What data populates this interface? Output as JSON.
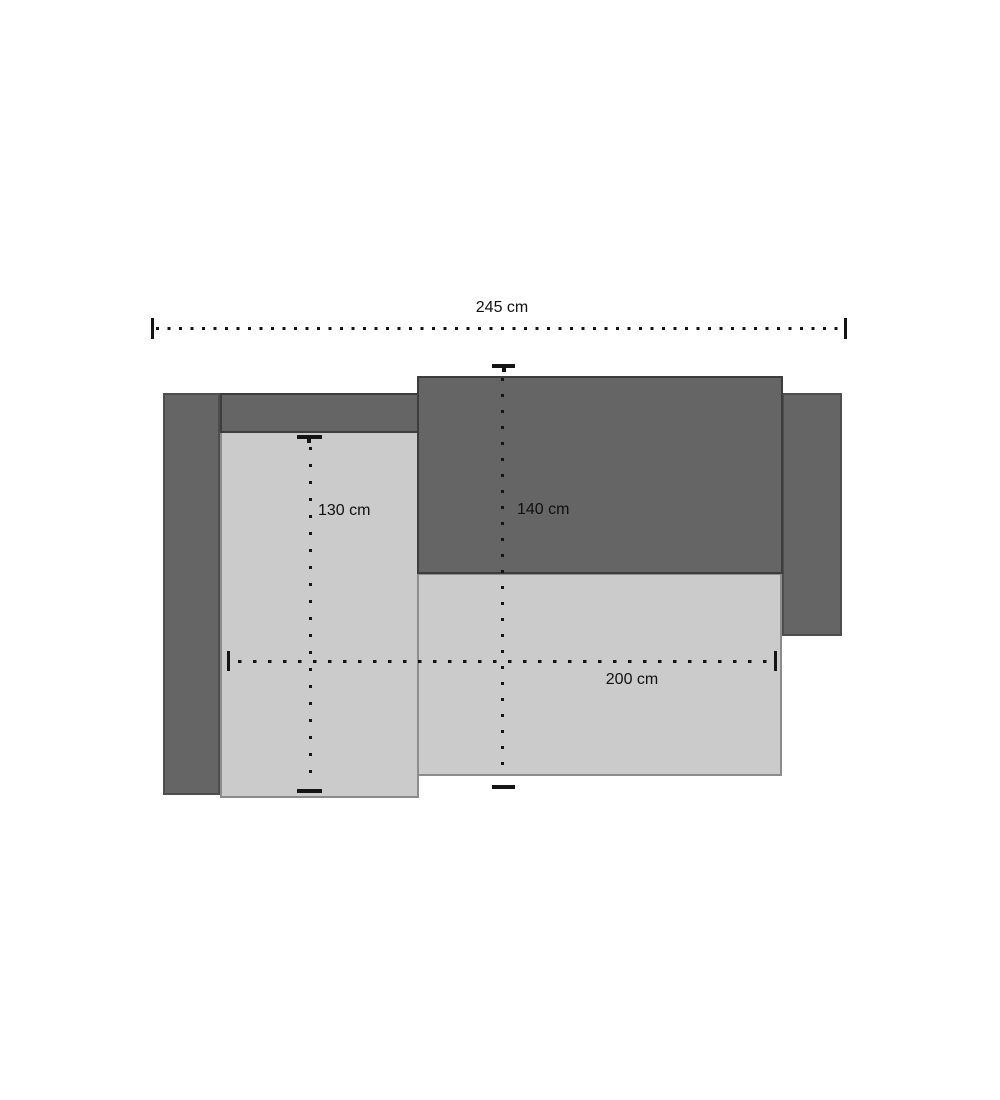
{
  "diagram": {
    "description": "Top-view dimension diagram of a corner sofa bed",
    "unit": "cm",
    "labels": {
      "width_total": "245 cm",
      "height_left": "130 cm",
      "height_center": "140 cm",
      "width_seat": "200 cm"
    },
    "values": {
      "width_total_cm": 245,
      "height_left_cm": 130,
      "height_center_cm": 140,
      "width_seat_cm": 200
    },
    "colors": {
      "dark_part_fill": "#656565",
      "dark_part_border": "#3d3d3d",
      "light_part_fill": "#cbcbcb",
      "light_part_border": "#8c8c8c",
      "dimension_ink": "#141414",
      "background": "#ffffff"
    },
    "parts": [
      {
        "name": "left-armrest",
        "tone": "dark"
      },
      {
        "name": "right-armrest",
        "tone": "dark"
      },
      {
        "name": "chaise-seat",
        "tone": "light"
      },
      {
        "name": "main-seat",
        "tone": "light"
      },
      {
        "name": "backrest-strip-left",
        "tone": "dark"
      },
      {
        "name": "backrest-main",
        "tone": "dark"
      }
    ]
  }
}
